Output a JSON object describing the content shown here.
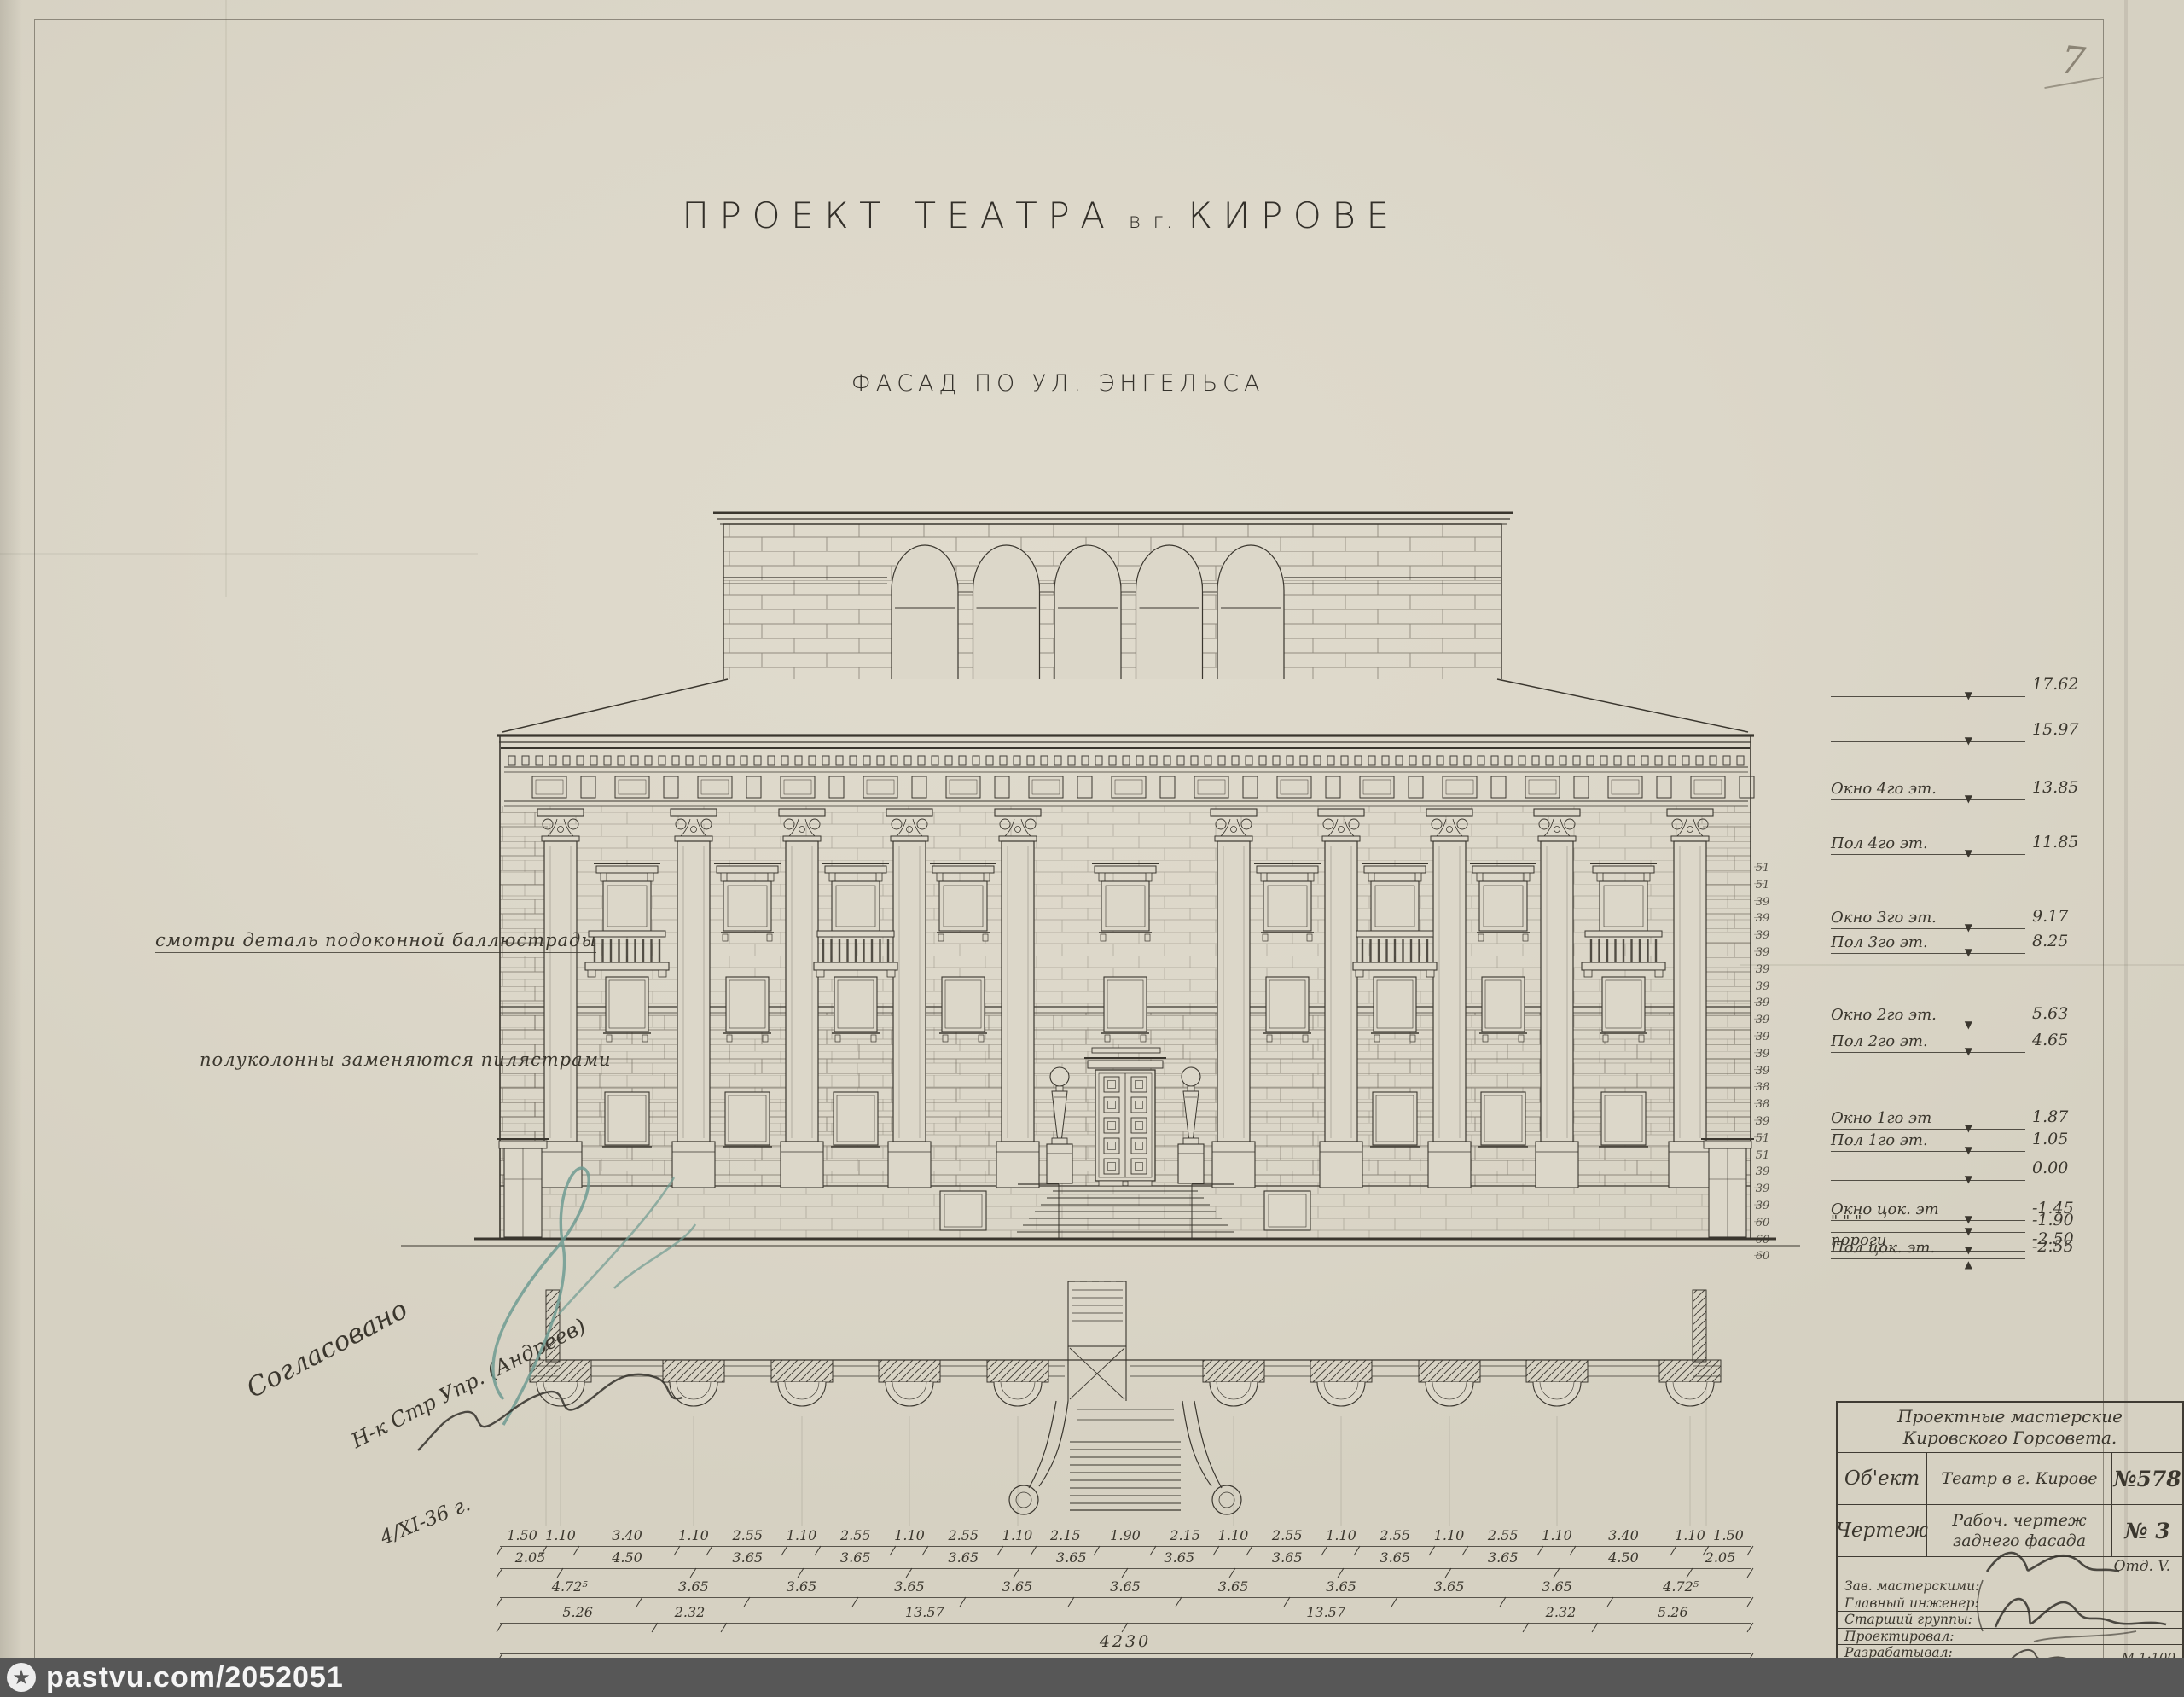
{
  "paper": {
    "background": "#dcd7c9",
    "ink": "#3a362e",
    "pencil": "#8b8475",
    "signature_blue": "#6f9b92"
  },
  "header": {
    "title_main": "ПРОЕКТ ТЕАТРА",
    "title_mid": "в г.",
    "title_city": "КИРОВЕ",
    "subtitle": "ФАСАД ПО УЛ. ЭНГЕЛЬСА"
  },
  "notes": {
    "note1": "смотри деталь подоконной баллюстрады",
    "note2": "полуколонны заменяются пилястрами"
  },
  "approval": {
    "line1": "Согласовано",
    "line2": "Н-к Стр Упр. (Андреев)",
    "date": "4/XI-36 г."
  },
  "page_number": "7",
  "elevation_marks": [
    {
      "label": "",
      "value": "17.62",
      "marker": "▼"
    },
    {
      "label": "",
      "value": "15.97",
      "marker": "▼"
    },
    {
      "label": "Окно 4го эт.",
      "value": "13.85",
      "marker": "▼"
    },
    {
      "label": "Пол 4го эт.",
      "value": "11.85",
      "marker": "▼"
    },
    {
      "label": "Окно 3го эт.",
      "value": "9.17",
      "marker": "▼"
    },
    {
      "label": "Пол 3го эт.",
      "value": "8.25",
      "marker": "▼"
    },
    {
      "label": "Окно 2го эт.",
      "value": "5.63",
      "marker": "▼"
    },
    {
      "label": "Пол 2го эт.",
      "value": "4.65",
      "marker": "▼"
    },
    {
      "label": "Окно 1го эт",
      "value": "1.87",
      "marker": "▼"
    },
    {
      "label": "Пол 1го эт.",
      "value": "1.05",
      "marker": "▼"
    },
    {
      "label": "",
      "value": "0.00",
      "marker": "▼"
    },
    {
      "label": "Окно цок. эт",
      "value": "-1.45",
      "marker": "▼"
    },
    {
      "label": "\"   \"   \"",
      "value": "-1.90",
      "marker": "▼"
    },
    {
      "label": "пороги",
      "value": "-2.50",
      "marker": "▼"
    },
    {
      "label": "Пол цок. эт.",
      "value": "-2.55",
      "marker": "▲"
    }
  ],
  "course_heights": [
    "51",
    "51",
    "39",
    "39",
    "39",
    "39",
    "39",
    "39",
    "39",
    "39",
    "39",
    "39",
    "39",
    "38",
    "38",
    "39",
    "51",
    "51",
    "39",
    "39",
    "39",
    "60",
    "60",
    "60"
  ],
  "dimensions": {
    "row1": [
      "1.50",
      "1.10",
      "3.40",
      "1.10",
      "2.55",
      "1.10",
      "2.55",
      "1.10",
      "2.55",
      "1.10",
      "2.15",
      "1.90",
      "2.15",
      "1.10",
      "2.55",
      "1.10",
      "2.55",
      "1.10",
      "2.55",
      "1.10",
      "3.40",
      "1.10",
      "1.50"
    ],
    "row2": [
      "2.05",
      "4.50",
      "3.65",
      "3.65",
      "3.65",
      "3.65",
      "3.65",
      "3.65",
      "3.65",
      "3.65",
      "4.50",
      "2.05"
    ],
    "row3": [
      "4.72⁵",
      "3.65",
      "3.65",
      "3.65",
      "3.65",
      "3.65",
      "3.65",
      "3.65",
      "3.65",
      "3.65",
      "4.72⁵"
    ],
    "row4": [
      "5.26",
      "2.32",
      "13.57",
      "13.57",
      "2.32",
      "5.26"
    ],
    "row5": [
      "4230"
    ]
  },
  "title_block": {
    "org_line1": "Проектные мастерские",
    "org_line2": "Кировского Горсовета.",
    "rows": [
      {
        "label": "Об'ект",
        "value": "Театр в г. Кирове",
        "number": "№578"
      },
      {
        "label": "Чертеж",
        "value": "Рабоч. чертеж заднего фасада",
        "number": "№ 3"
      }
    ],
    "dept": "Отд. V.",
    "signature_rows": [
      "Зав. мастерскими:",
      "Главный инженер:",
      "Старший группы:",
      "Проектировал:",
      "Разрабатывал:",
      "Копировал:"
    ],
    "scale": "М 1:100"
  },
  "watermark": {
    "site": "pastvu.com/2052051"
  }
}
